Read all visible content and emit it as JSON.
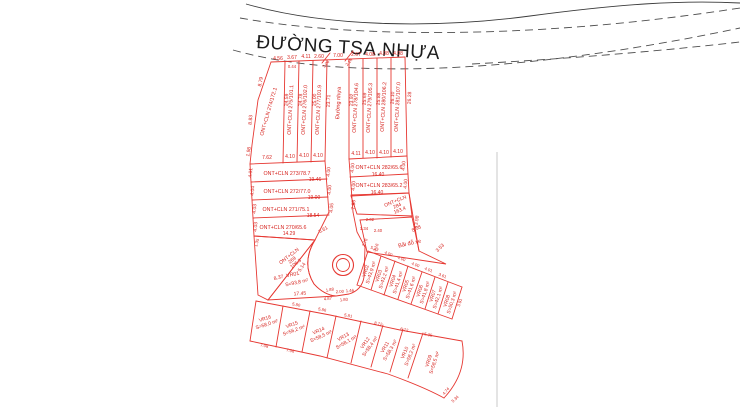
{
  "map": {
    "title": "ĐƯỜNG TSA.NHỰA",
    "main_road_label": "Đường nhựa",
    "parking_label": "Bãi đỗ xe",
    "colors": {
      "plot_line": "#e63832",
      "plot_text": "#d6241f",
      "boundary_dash": "#4d4d4d"
    }
  },
  "top_row": {
    "plots": [
      "ONT+CLN 274/172.1",
      "ONT+CLN 275/101.1",
      "ONT+CLN 276/102.0",
      "ONT+CLN 277/101.9",
      "ONT+CLN 278/104.6",
      "ONT+CLN 279/105.3",
      "ONT+CLN 280/106.2",
      "ONT+CLN 281/107.0"
    ],
    "top_dims": [
      "4.56",
      "3.67",
      "4.11",
      "2.60",
      "7.00",
      "2.67",
      "4.08",
      "4.08",
      "4.08"
    ],
    "small_top_dims": [
      "0.44",
      "3.06",
      "2.18"
    ],
    "left_edge_dims": [
      "8.79",
      "8.83",
      "1.98"
    ],
    "boundary_lengths": [
      "24.59",
      "24.78",
      "25.00",
      "23.71",
      "23.92",
      "25.69",
      "25.88",
      "26.10",
      "26.28"
    ],
    "bottom_dims": [
      "7.62",
      "4.10",
      "4.10",
      "4.10",
      "4.11",
      "4.10",
      "4.10",
      "4.10"
    ]
  },
  "left_stack": {
    "rows": [
      {
        "label": "ONT+CLN 273/78.7",
        "width": "19.46",
        "left_dim": "4.01",
        "right_dim": "4.00"
      },
      {
        "label": "ONT+CLN 272/77.0",
        "width": "19.00",
        "left_dim": "4.04",
        "right_dim": "4.00"
      },
      {
        "label": "ONT+CLN 271/75.1",
        "width": "18.54",
        "left_dim": "4.03",
        "right_dim": "4.05"
      },
      {
        "label": "ONT+CLN 270/65.6",
        "width": "14.29",
        "left_dim": "4.03",
        "right_dim": "5.61"
      }
    ],
    "bottom_left_dim": "1.35"
  },
  "right_stack": {
    "rows": [
      {
        "label": "ONT+CLN 282/65.6",
        "width": "16.40",
        "left_dim": "4.00",
        "right_dim": "4.00"
      },
      {
        "label": "ONT+CLN 283/65.2",
        "width": "16.40",
        "left_dim": "4.00",
        "right_dim": "4.00"
      }
    ],
    "right_edge_dim": "13.98"
  },
  "plot_284": {
    "line1": "ONT+CLN",
    "line2": "284",
    "line3": "163.4",
    "dims": [
      "7.83",
      "2.02",
      "1.34",
      "2.40",
      "8.58",
      "3.53"
    ]
  },
  "plot_269": {
    "line1": "ONT+CLN",
    "line2": "269",
    "line3": "106.3",
    "dims": [
      "8.37",
      "5.14"
    ]
  },
  "vr01": {
    "name": "VR01",
    "area": "S=93,8 m²",
    "dims": [
      "17.45",
      "4.87",
      "1.80"
    ]
  },
  "vr_upper_row": {
    "plots": [
      {
        "name": "VR02",
        "area": "S=43,9 m²"
      },
      {
        "name": "VR03",
        "area": "S=43,2 m²"
      },
      {
        "name": "VR04",
        "area": "S=41,4 m²"
      },
      {
        "name": "VR05",
        "area": "S=41,6 m²"
      },
      {
        "name": "VR06",
        "area": "S=41,8 m²"
      },
      {
        "name": "VR07",
        "area": "S=42,1 m²"
      },
      {
        "name": "VR08",
        "area": "S=50,3 m²"
      }
    ],
    "top_dims": [
      "5.43",
      "4.00",
      "4.00",
      "4.00",
      "4.01",
      "3.61"
    ],
    "side_dims": [
      "2.76",
      "3.16",
      "3.91"
    ]
  },
  "vr_lower_row": {
    "plots": [
      {
        "name": "VR16",
        "area": "S=58,0 m²"
      },
      {
        "name": "VR15",
        "area": "S=56,2 m²"
      },
      {
        "name": "VR14",
        "area": "S=58,5 m²"
      },
      {
        "name": "VR13",
        "area": "S=58,1 m²"
      },
      {
        "name": "VR12",
        "area": "S=58,4 m²"
      },
      {
        "name": "VR11",
        "area": "S=58,3 m²"
      },
      {
        "name": "VR10",
        "area": "S=58,2 m²"
      },
      {
        "name": "VR09",
        "area": "S=58,5 m²"
      }
    ],
    "street_dims": [
      "5.80",
      "5.86",
      "5.81",
      "8.72",
      "6.72",
      "5.35"
    ],
    "bottom_dims": [
      "7.08",
      "7.06",
      "4.74",
      "5.34"
    ]
  },
  "culdesac_dims": [
    "1.88",
    "2.00",
    "1.46"
  ]
}
